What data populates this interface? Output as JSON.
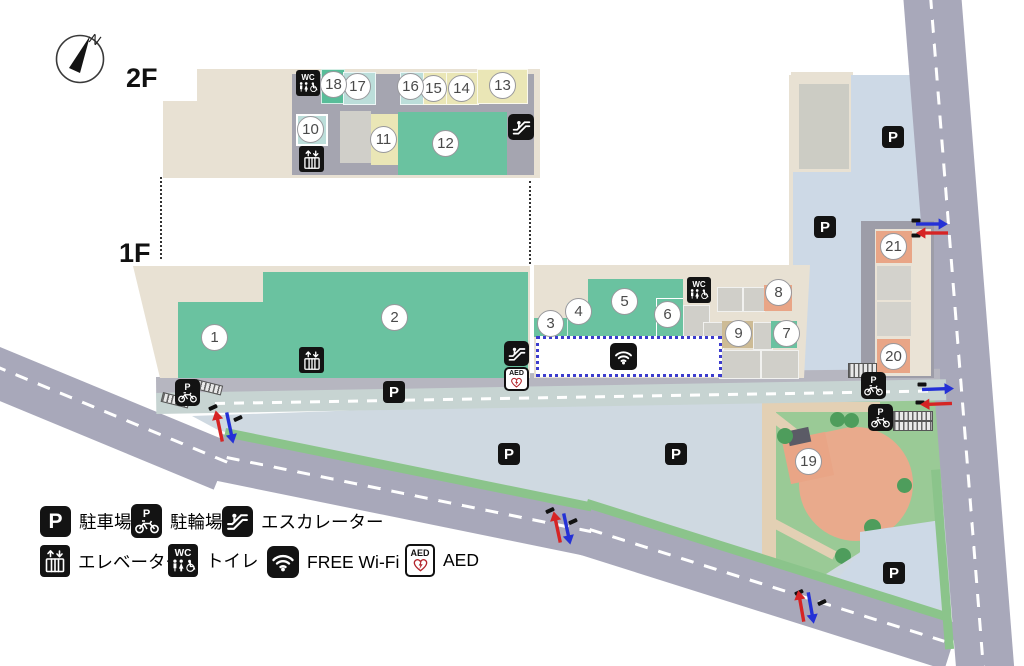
{
  "palette": {
    "building_beige": "#e8e1d3",
    "shop_green": "#6ac2a0",
    "shop_teal_light": "#bcdeda",
    "shop_yellow": "#eae6b6",
    "shop_salmon": "#e9a586",
    "shop_tan": "#cdbb95",
    "road_gray": "#a8a8ba",
    "parking_blue": "#cfd9e1",
    "park_green": "#9aca96",
    "wifi_border_blue": "#3c3ccd",
    "entry_arrow_blue": "#2431d6",
    "exit_arrow_red": "#d62424"
  },
  "compass": {
    "north_label": "N"
  },
  "floors": {
    "f2_label": "2F",
    "f1_label": "1F"
  },
  "markers": {
    "parking_letter": "P",
    "wc_label": "WC",
    "aed_label": "AED"
  },
  "shops": [
    {
      "num": "1"
    },
    {
      "num": "2"
    },
    {
      "num": "3"
    },
    {
      "num": "4"
    },
    {
      "num": "5"
    },
    {
      "num": "6"
    },
    {
      "num": "7"
    },
    {
      "num": "8"
    },
    {
      "num": "9"
    },
    {
      "num": "10"
    },
    {
      "num": "11"
    },
    {
      "num": "12"
    },
    {
      "num": "13"
    },
    {
      "num": "14"
    },
    {
      "num": "15"
    },
    {
      "num": "16"
    },
    {
      "num": "17"
    },
    {
      "num": "18"
    },
    {
      "num": "19"
    },
    {
      "num": "20"
    },
    {
      "num": "21"
    }
  ],
  "legend": {
    "items": [
      {
        "icon": "parking-icon",
        "label": "駐車場"
      },
      {
        "icon": "bicycle-parking-icon",
        "label": "駐輪場"
      },
      {
        "icon": "escalator-icon",
        "label": "エスカレーター"
      },
      {
        "icon": "elevator-icon",
        "label": "エレベーター"
      },
      {
        "icon": "toilet-icon",
        "label": "トイレ"
      },
      {
        "icon": "wifi-icon",
        "label": "FREE Wi-Fi"
      },
      {
        "icon": "aed-icon",
        "label": "AED"
      }
    ]
  }
}
